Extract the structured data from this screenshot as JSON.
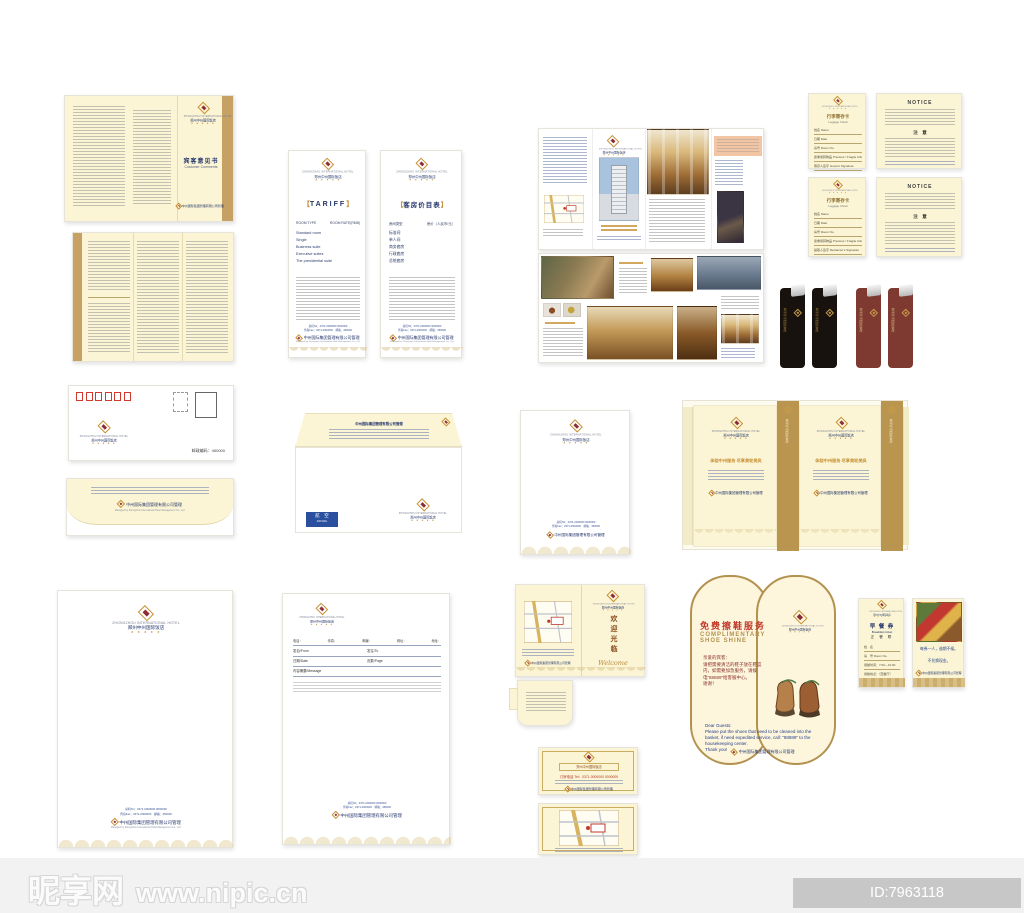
{
  "brand": {
    "en": "ZHONGZHOU INTERNATIONAL HOTEL",
    "cn": "郑州中州国际饭店",
    "stars": "★ ★ ★ ★ ★",
    "mgmt_cn": "中州国际集团管理有限公司管理",
    "mgmt_en": "Managed by Zhongzhou International Hotel Management Co., Ltd.",
    "tel_line": "总机Tel：0371-0000000 0000000",
    "fax_line": "传真Fax：0371-0000000　邮编：450000"
  },
  "ui": {
    "bl": "【",
    "br": "】"
  },
  "comments": {
    "title_cn": "宾客意见书",
    "title_en": "Customer Comments"
  },
  "tariff_en": {
    "title": "TARIFF",
    "col1": "ROOM TYPE",
    "col2": "ROOM RATE(RMB)",
    "rooms": [
      "Standard room",
      "Single",
      "Business suite",
      "Executive suites",
      "The presidential suite"
    ]
  },
  "tariff_cn": {
    "title": "客房价目表",
    "col1": "房间类型",
    "col2": "房价（人民币/元）",
    "rooms": [
      "标准间",
      "单人间",
      "商务套房",
      "行政套房",
      "总统套房"
    ]
  },
  "luggage": {
    "title_cn": "行李寄存卡",
    "title_en": "Luggage Check",
    "fields": [
      "姓名 Name",
      "日期 Date",
      "房号 Room No.",
      "贵重易碎物品 Precious / Fragile Article",
      "寄存人签字 Guest's Signature",
      "提取人签字 Reclaimer's Signature"
    ]
  },
  "notice": {
    "title": "NOTICE",
    "subtitle": "注　意"
  },
  "envelope": {
    "postcode": "邮政编码：450000",
    "airmail_cn": "航　空",
    "airmail_en": "AIR MAIL"
  },
  "bag": {
    "slogan": "体验中州服务 尽享美轮美奂"
  },
  "welcome": {
    "title_cn": "欢迎光临",
    "title_en": "Welcome"
  },
  "vip_card": {
    "box": "郑州中州国际饭店",
    "tel": "订房电话 Tel：0371-0000000 0000000"
  },
  "shoe": {
    "title_cn": "免费擦鞋服务",
    "en_line1": "COMPLIMENTARY",
    "en_line2": "SHOE SHINE",
    "cn1": "亲爱的宾客：",
    "cn2": "请把需要清洁的鞋子放在鞋篮内，如需要加急服务，请拨电“88889”给客服中心。",
    "cn3": "谢谢！",
    "en1": "Dear Guests:",
    "en2": "Please put the shoes that need to be cleaned into the basket, if need expedited service, call: \"88889\" to the housekeeping center.",
    "en3": "Thank you!"
  },
  "breakfast": {
    "title_cn": "早 餐 券",
    "title_en": "Breakfast ticket",
    "sub": "正 餐 联",
    "f1": "姓　名",
    "f2": "房　号 Room No.",
    "f3": "用餐时间：7:00—10:00",
    "f4": "用餐地点：（西餐厅）",
    "note1": "每券一人，逾期不候。",
    "note2": "不兑换现金。"
  },
  "fax": {
    "labels": [
      "电话：",
      "传真：",
      "邮编：",
      "网址：",
      "地址："
    ],
    "r1a": "发自/From",
    "r1b": "发往/To",
    "r2a": "日期/Date",
    "r2b": "页数/Page",
    "r3": "内容摘要/Message"
  },
  "watermark": {
    "site": "昵享网",
    "url": "www.nipic.cn",
    "id": "ID:7963118 NO:20121103125511034306"
  }
}
